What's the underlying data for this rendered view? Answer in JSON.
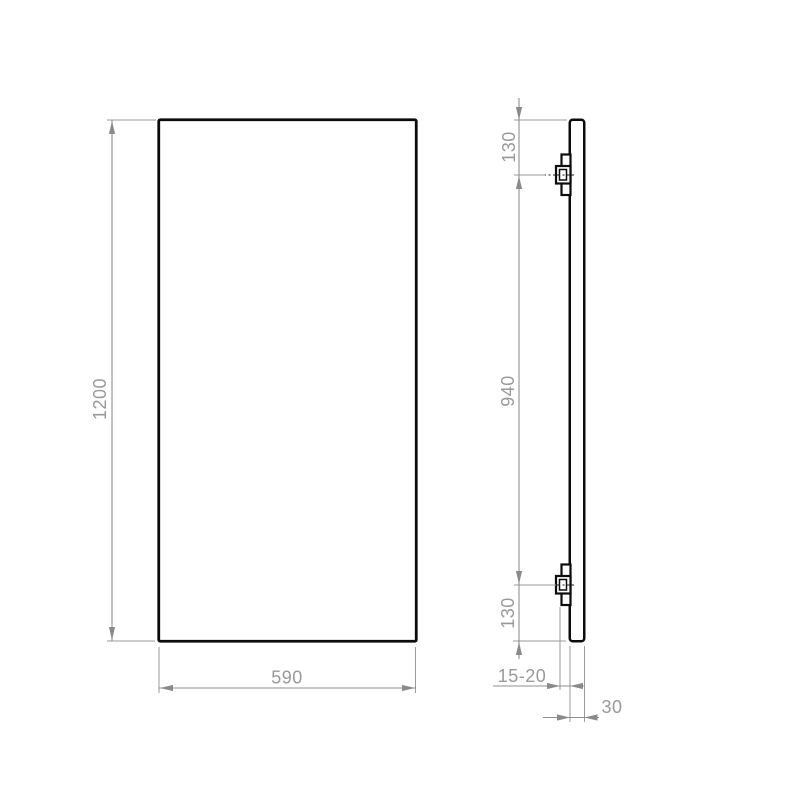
{
  "drawing": {
    "type": "technical-drawing",
    "views": {
      "front_view": {
        "height_label": "1200",
        "width_label": "590"
      },
      "side_view": {
        "top_bracket_offset_label": "130",
        "bracket_spacing_label": "940",
        "bottom_bracket_offset_label": "130",
        "wall_gap_label": "15-20",
        "panel_thickness_label": "30"
      }
    },
    "colors": {
      "background": "#ffffff",
      "part_outline": "#0c0c0c",
      "dimension_lines": "#8f8f8f",
      "dimension_text": "#999999"
    }
  }
}
